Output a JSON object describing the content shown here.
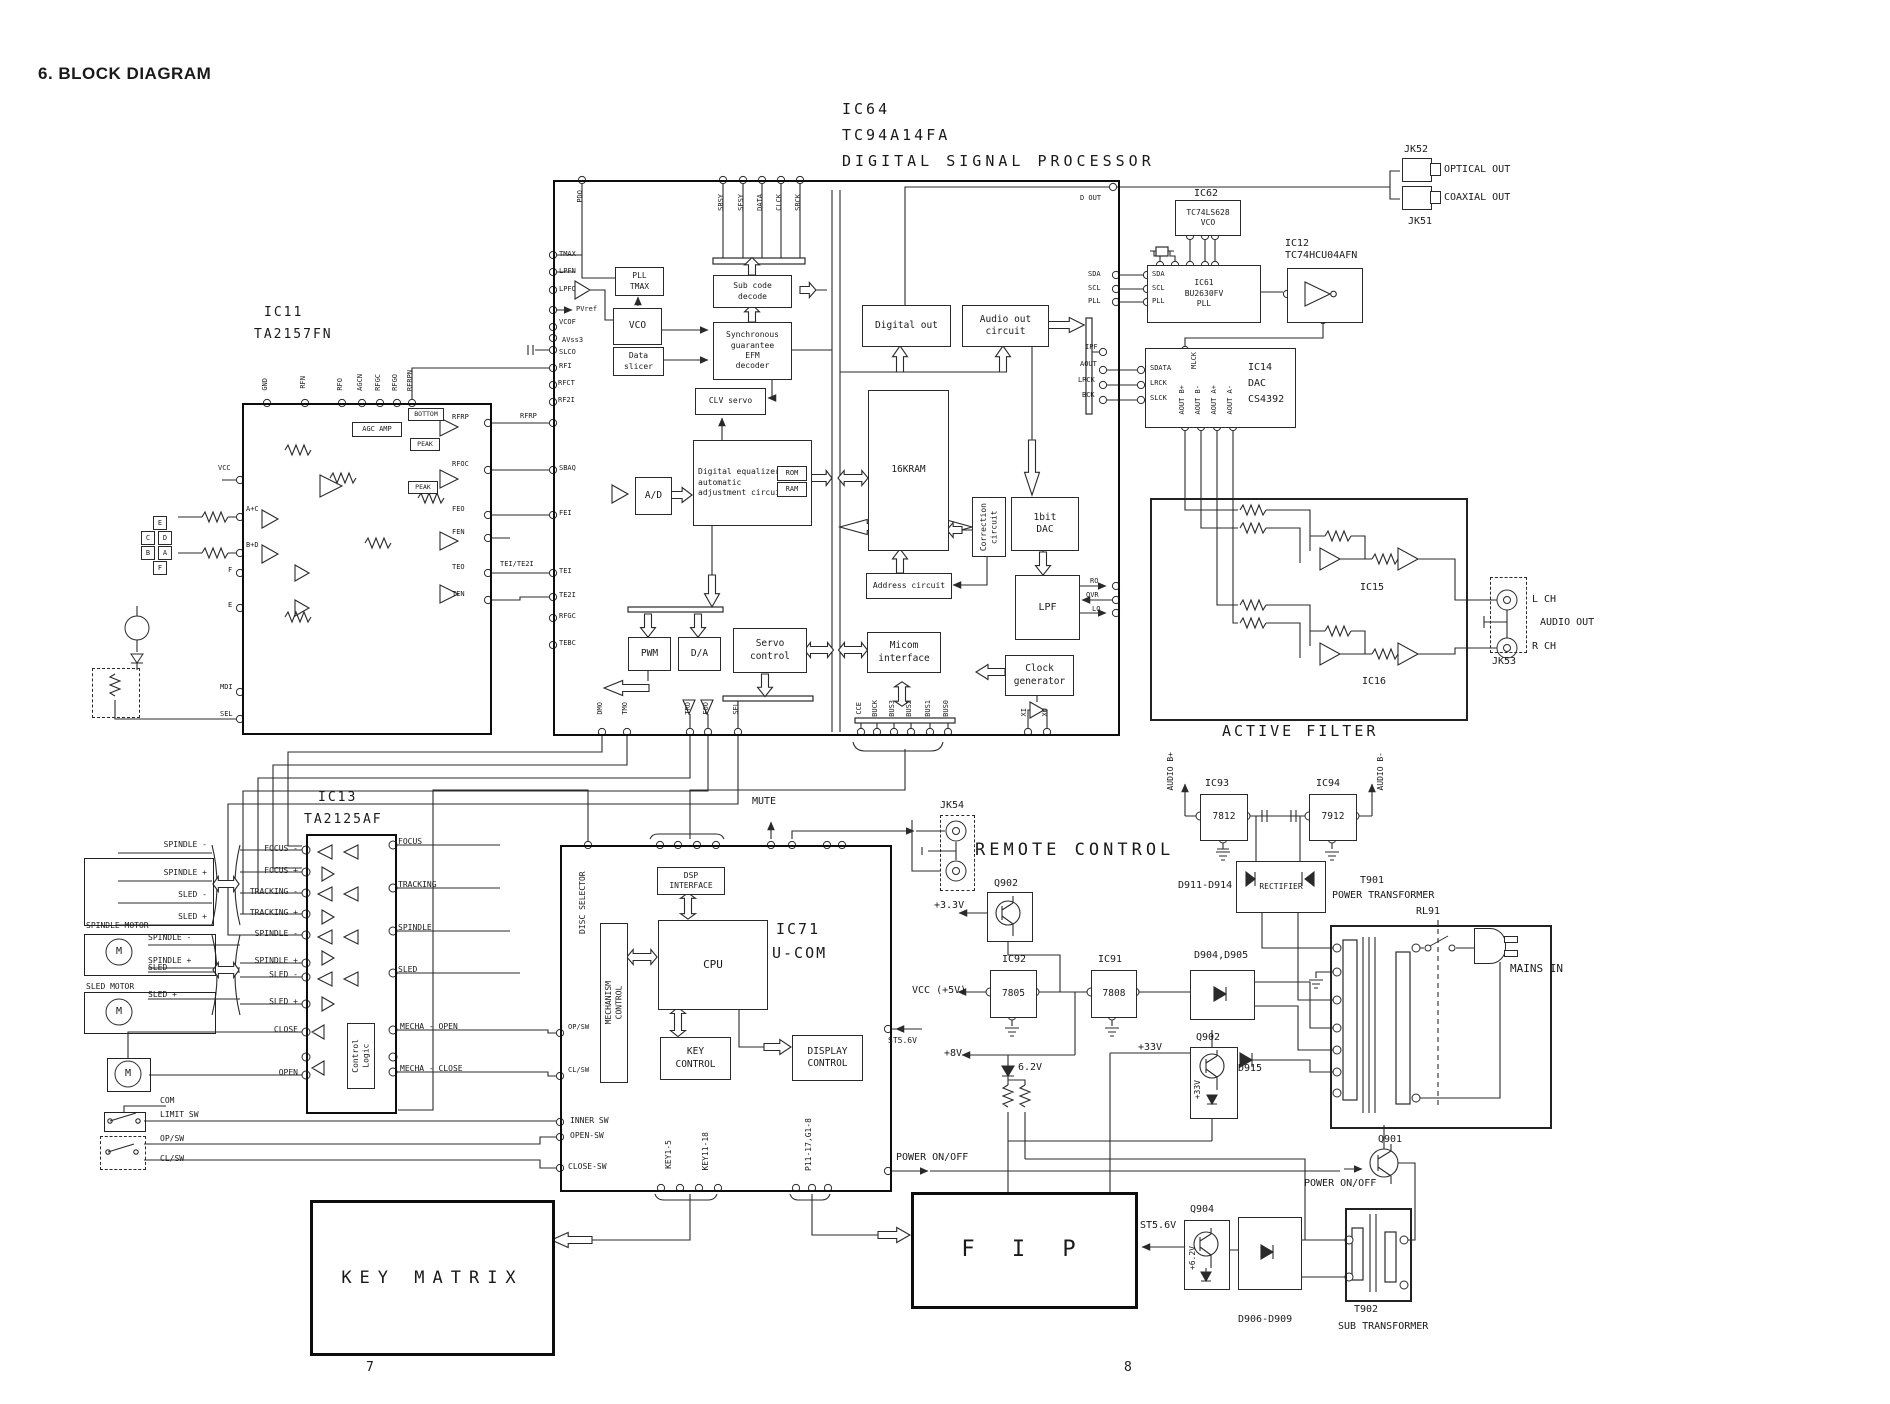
{
  "header": "6. BLOCK DIAGRAM",
  "pages": {
    "left": "7",
    "right": "8"
  },
  "L": {
    "ic64": "IC64",
    "ic64_part": "TC94A14FA",
    "ic64_name": "DIGITAL SIGNAL PROCESSOR",
    "pll_tmax": "PLL\nTMAX",
    "subcode": "Sub code\ndecode",
    "vco": "VCO",
    "data_slicer": "Data\nslicer",
    "efm": "Synchronous\nguarantee\nEFM\ndecoder",
    "clv": "CLV servo",
    "deq": "Digital equalizer\nautomatic\nadjustment circuit",
    "rom": "ROM",
    "ram": "RAM",
    "ad": "A/D",
    "kram": "16KRAM",
    "addr": "Address circuit",
    "corr": "Correction\ncircuit",
    "dac1": "1bit\nDAC",
    "lpf": "LPF",
    "pwm": "PWM",
    "da": "D/A",
    "servo": "Servo\ncontrol",
    "micom": "Micom\ninterface",
    "clock": "Clock\ngenerator",
    "digout": "Digital out",
    "audioout": "Audio out\ncircuit",
    "sbsy": "SBSY",
    "sfsy": "SFSY",
    "data": "DATA",
    "clck": "CLCK",
    "sbck": "SBCK",
    "pdo": "PDO",
    "dout": "D OUT",
    "tmax": "TMAX",
    "lpfn": "LPFN",
    "lpfo": "LPFO",
    "pvref": "PVref",
    "vcof": "VCOF",
    "avss3": "AVss3",
    "slco": "SLCO",
    "rfi": "RFI",
    "rfct": "RFCT",
    "rf2i": "RF2I",
    "rfrp": "RFRP",
    "sbaq": "SBAQ",
    "fei": "FEI",
    "tei": "TEI",
    "tei_te2i": "TEI/TE2I",
    "te2i": "TE2I",
    "rfgc": "RFGC",
    "tebc": "TEBC",
    "sda": "SDA",
    "scl": "SCL",
    "pll": "PLL",
    "ipf": "IPF",
    "aout": "AOUT",
    "lrck": "LRCK",
    "bck": "BCK",
    "ro": "RO",
    "ovr": "OVR",
    "lo": "LO",
    "dmo": "DMO",
    "tmo": "TMO",
    "tro": "TRO",
    "foo": "FOO",
    "sel": "SEL",
    "cce": "CCE",
    "buck": "BUCK",
    "bus3": "BUS3",
    "bus2": "BUS2",
    "bus1": "BUS1",
    "bus0": "BUS0",
    "xi": "XI",
    "xo": "XO",
    "ic62": "IC62",
    "ic62_part": "TC74LS628\nVCO",
    "ic61": "IC61\nBU2630FV\nPLL",
    "ic12": "IC12\nTC74HCU04AFN",
    "jk52": "JK52",
    "jk51": "JK51",
    "optical": "OPTICAL OUT",
    "coaxial": "COAXIAL OUT",
    "ic14": "IC14\nDAC\nCS4392",
    "sdata": "SDATA",
    "slck": "SLCK",
    "mlck": "MLCK",
    "aout_bp": "AOUT B+",
    "aout_bm": "AOUT B-",
    "aout_ap": "AOUT A+",
    "aout_am": "AOUT A-",
    "active_filter": "ACTIVE FILTER",
    "ic15": "IC15",
    "ic16": "IC16",
    "jk53": "JK53",
    "lch": "L CH",
    "rch": "R CH",
    "audio_out": "AUDIO OUT",
    "ic11": "IC11",
    "ic11_part": "TA2157FN",
    "vcc": "VCC",
    "a_c": "A+C",
    "b_d": "B+D",
    "f": "F",
    "e": "E",
    "mdi": "MDI",
    "gnd": "GND",
    "agc": "AGC AMP",
    "peak": "PEAK",
    "bottom": "BOTTOM",
    "rfn": "RFN",
    "rfo": "RFO",
    "agcn": "AGCN",
    "rfgo": "RFGO",
    "rfrpn": "RFRPN",
    "rfoc": "RFOC",
    "feo": "FEO",
    "fen": "FEN",
    "teo": "TEO",
    "ten": "TEN",
    "pd_e": "E",
    "pd_c": "C",
    "pd_d": "D",
    "pd_b": "B",
    "pd_a": "A",
    "pd_f": "F",
    "ic13": "IC13",
    "ic13_part": "TA2125AF",
    "focus_m": "FOCUS -",
    "focus_p": "FOCUS +",
    "track_m": "TRACKING -",
    "track_p": "TRACKING +",
    "spin_m": "SPINDLE -",
    "spin_p": "SPINDLE +",
    "sled_m": "SLED -",
    "sled_p": "SLED +",
    "close": "CLOSE",
    "open": "OPEN",
    "ctrl": "Control\nLogic",
    "mecha_o": "MECHA - OPEN",
    "mecha_c": "MECHA - CLOSE",
    "focus": "FOCUS",
    "tracking": "TRACKING",
    "spindle": "SPINDLE",
    "sled": "SLED",
    "spindle_motor": "SPINDLE MOTOR",
    "sled_motor": "SLED MOTOR",
    "m": "M",
    "com": "COM",
    "limit_sw": "LIMIT SW",
    "op_sw": "OP/SW",
    "cl_sw": "CL/SW",
    "ic71": "IC71",
    "ucom": "U-COM",
    "cpu": "CPU",
    "dsp_if": "DSP\nINTERFACE",
    "mech": "MECHANISM\nCONTROL",
    "key_ctrl": "KEY\nCONTROL",
    "disp_ctrl": "DISPLAY\nCONTROL",
    "disc_sel": "DISC SELECTOR",
    "mute": "MUTE",
    "key15": "KEY1-5",
    "key1118": "KEY11-18",
    "p1117": "P11-17,G1-8",
    "inner_sw": "INNER SW",
    "open_sw": "OPEN-SW",
    "close_sw": "CLOSE-SW",
    "power": "POWER ON/OFF",
    "st56": "ST5.6V",
    "key_matrix": "KEY MATRIX",
    "fip": "F I P",
    "jk54": "JK54",
    "remote": "REMOTE CONTROL",
    "q902": "Q902",
    "q901": "Q901",
    "q904": "Q904",
    "ic92": "IC92",
    "r7805": "7805",
    "ic91": "IC91",
    "r7808": "7808",
    "ic93": "IC93",
    "r7812": "7812",
    "ic94": "IC94",
    "r7912": "7912",
    "vcc5": "VCC (+5V)",
    "p8": "+8V",
    "z62": "6.2V",
    "p33": "+3.3V",
    "p33v": "+33V",
    "d915": "D915",
    "d904": "D904,D905",
    "d911": "D911-D914",
    "rect": "RECTIFIER",
    "t901": "T901",
    "pwr_tr": "POWER TRANSFORMER",
    "rl91": "RL91",
    "mains": "MAINS IN",
    "audio_bp2": "AUDIO B+",
    "audio_bm2": "AUDIO B-",
    "t902": "T902",
    "sub_tr": "SUB TRANSFORMER",
    "d906": "D906-D909",
    "p62": "+6.2V"
  }
}
